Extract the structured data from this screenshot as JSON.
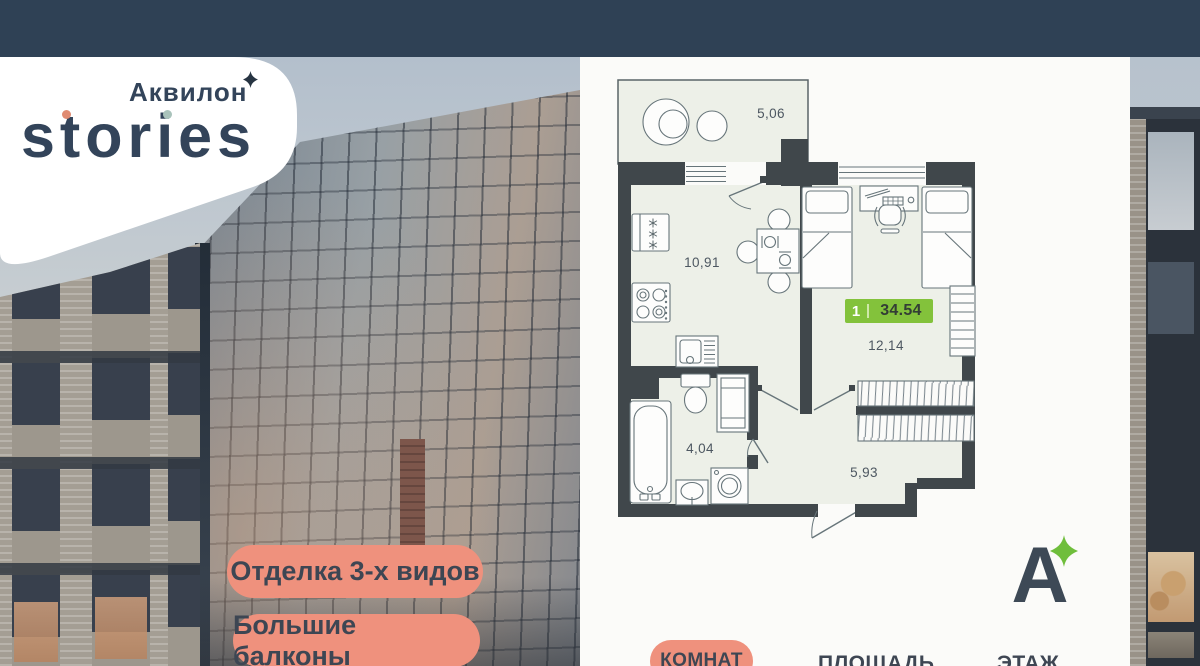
{
  "brand": {
    "line1": "Аквилон",
    "line2": "stories"
  },
  "promo_badges": {
    "finish": "Отделка 3-х видов",
    "balconies": "Большие балконы"
  },
  "floorplan": {
    "areas": {
      "balcony": "5,06",
      "kitchen": "10,91",
      "room": "12,14",
      "bathroom": "4,04",
      "hallway": "5,93"
    },
    "badge": {
      "rooms": "1",
      "area": "34.54"
    }
  },
  "footer": {
    "rooms_label": "КОМНАТ",
    "area_label": "ПЛОЩАДЬ",
    "floor_label": "ЭТАЖ",
    "logo_letter": "А"
  },
  "colors": {
    "topbar": "#2f4155",
    "promo_badge": "#ef917d",
    "area_badge_green": "#83c23b",
    "brand_text": "#33445a",
    "dot_t": "#e08b72",
    "dot_i": "#a9c3bb",
    "star_green": "#6fbe3c"
  }
}
